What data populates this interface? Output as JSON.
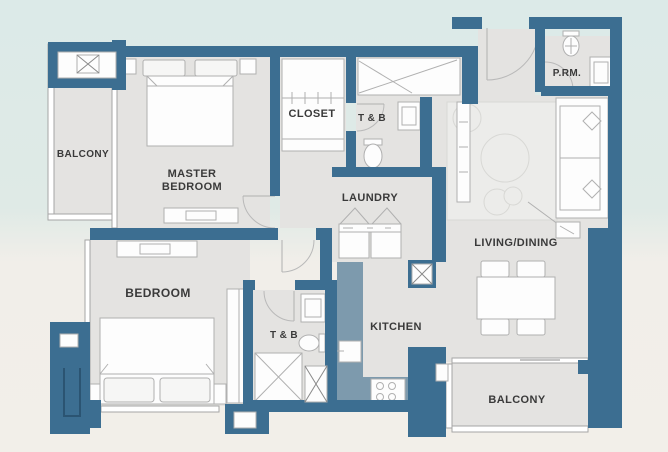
{
  "plan": {
    "rooms": {
      "balcony_top": "BALCONY",
      "master_bedroom_line1": "MASTER",
      "master_bedroom_line2": "BEDROOM",
      "closet": "CLOSET",
      "toilet_bath_upper": "T & B",
      "laundry": "LAUNDRY",
      "powder_room": "P.RM.",
      "living_dining": "LIVING/DINING",
      "bedroom": "BEDROOM",
      "toilet_bath_lower": "T & B",
      "kitchen": "KITCHEN",
      "balcony_bottom": "BALCONY"
    },
    "colors": {
      "wall": "#3c6e91",
      "counter": "#7d9aad",
      "floor": "#e4e3e1",
      "rug": "#ececea",
      "bg_top": "#dceae8",
      "bg_bottom": "#f2efe9",
      "label_text": "#3a3a3a",
      "fixture_stroke": "#b0b0b0"
    }
  }
}
